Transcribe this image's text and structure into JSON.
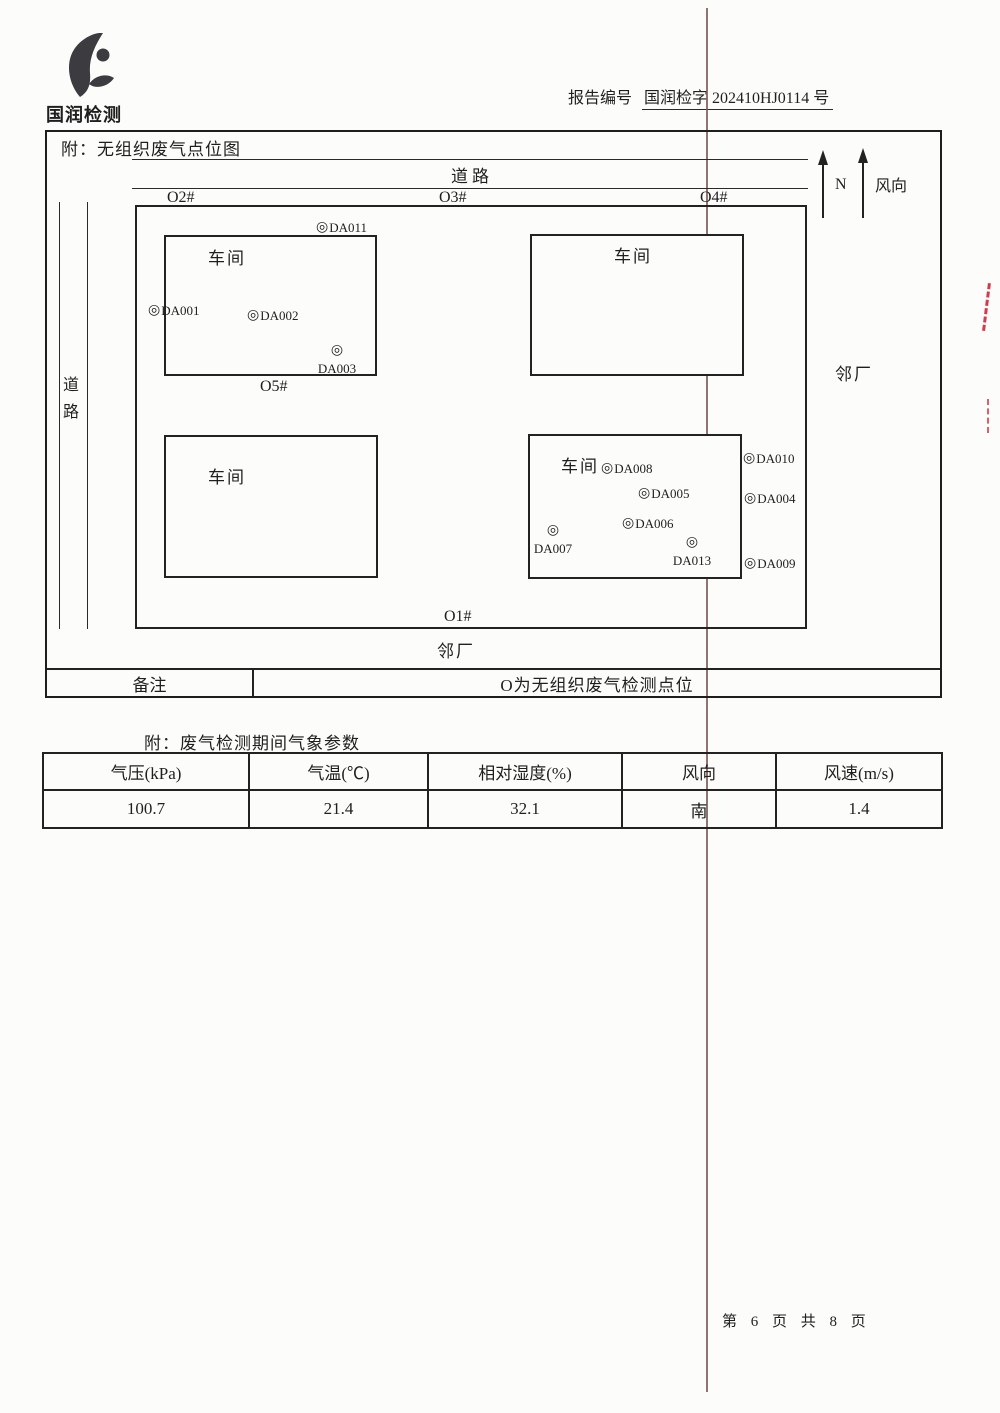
{
  "page": {
    "background": "#fcfcfa",
    "ink": "#1f1f1f",
    "fold_line_color": "#7d5a5a",
    "red_mark_color": "#d23a4e"
  },
  "header": {
    "logo_text": "国润检测",
    "report_label": "报告编号",
    "report_number": "国润检字 202410HJ0114",
    "report_suffix": "号"
  },
  "diagram": {
    "title": "附：无组织废气点位图",
    "road_top": "道路",
    "road_left": "道路",
    "north_label": "N",
    "wind_label": "风向",
    "neighbor_right": "邻厂",
    "neighbor_bottom": "邻厂",
    "marker": "◎",
    "boundary_labels": {
      "o1": "O1#",
      "o2": "O2#",
      "o3": "O3#",
      "o4": "O4#",
      "o5": "O5#"
    },
    "workshops": [
      "车间",
      "车间",
      "车间",
      "车间"
    ],
    "points": {
      "da001": "DA001",
      "da002": "DA002",
      "da003": "DA003",
      "da004": "DA004",
      "da005": "DA005",
      "da006": "DA006",
      "da007": "DA007",
      "da008": "DA008",
      "da009": "DA009",
      "da010": "DA010",
      "da011": "DA011",
      "da013": "DA013"
    },
    "remark": {
      "label": "备注",
      "text": "O为无组织废气检测点位"
    }
  },
  "weather": {
    "title": "附：废气检测期间气象参数",
    "columns": [
      "气压(kPa)",
      "气温(℃)",
      "相对湿度(%)",
      "风向",
      "风速(m/s)"
    ],
    "values": [
      "100.7",
      "21.4",
      "32.1",
      "南",
      "1.4"
    ]
  },
  "footer": {
    "page_info": "第 6 页 共 8 页"
  }
}
